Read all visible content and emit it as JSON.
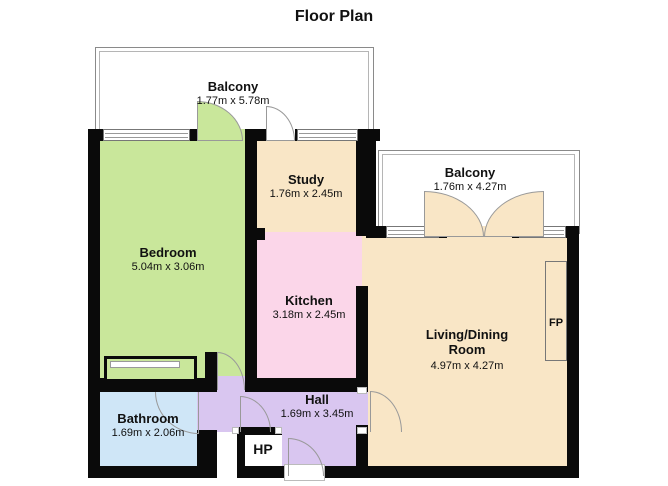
{
  "title": "Floor Plan",
  "colors": {
    "bedroom": "#c9e79b",
    "wheat": "#f9e6c6",
    "kitchen": "#fbd6e9",
    "hall": "#d9c6f0",
    "bathroom": "#cfe6f7",
    "hp": "#f9c98f",
    "wall": "#0a0a0a",
    "arc_stroke": "#999999",
    "balcony_floor": "#ffffff"
  },
  "rooms": {
    "balcony_top": {
      "name": "Balcony",
      "dims": "1.77m x 5.78m"
    },
    "balcony_right": {
      "name": "Balcony",
      "dims": "1.76m x 4.27m"
    },
    "bedroom": {
      "name": "Bedroom",
      "dims": "5.04m x 3.06m"
    },
    "study": {
      "name": "Study",
      "dims": "1.76m x 2.45m"
    },
    "kitchen": {
      "name": "Kitchen",
      "dims": "3.18m x 2.45m"
    },
    "living": {
      "name_line1": "Living/Dining",
      "name_line2": "Room",
      "dims": "4.97m x 4.27m"
    },
    "hall": {
      "name": "Hall",
      "dims": "1.69m x 3.45m"
    },
    "bathroom": {
      "name": "Bathroom",
      "dims": "1.69m x 2.06m"
    },
    "hp": {
      "label": "HP"
    },
    "fp": {
      "label": "FP"
    }
  }
}
